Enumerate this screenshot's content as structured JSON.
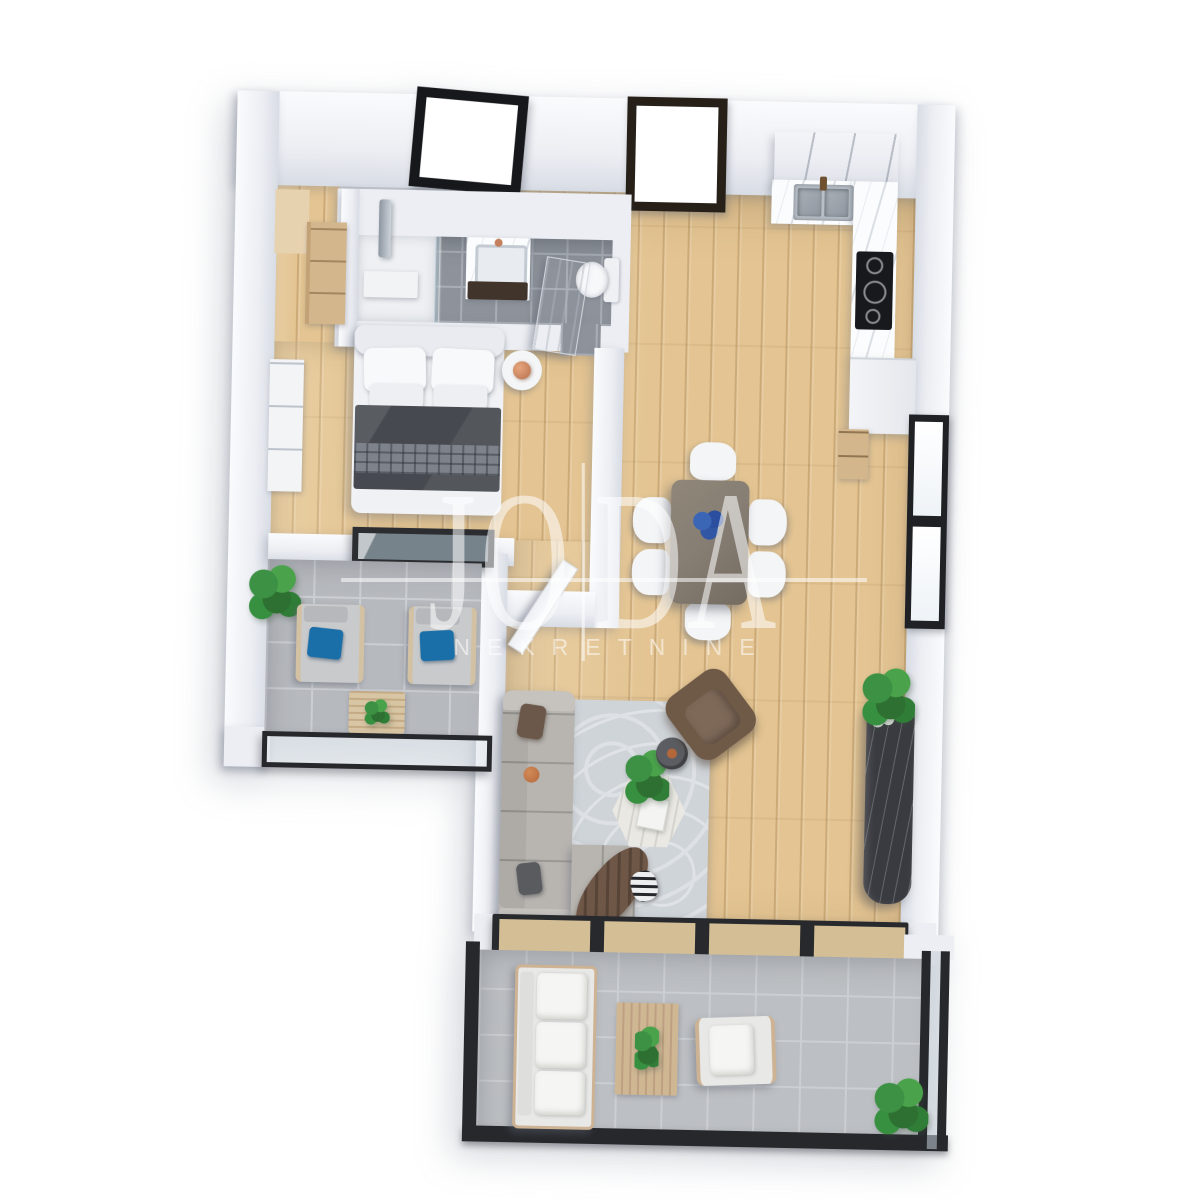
{
  "watermark": {
    "brand_left": "JO",
    "brand_right": "DA",
    "subtitle": "NEKRETNINE"
  },
  "palette": {
    "background": "#ffffff",
    "wall_top": "#fafbfd",
    "wall_face": "#eceef3",
    "wall_shade": "#d8dce4",
    "wood": "#e3c492",
    "wood_light": "#ecd4a6",
    "wood_furniture": "#d3b68c",
    "bath_tile": "#8e939b",
    "bath_grout": "#a9aeb6",
    "out_tile": "#b6b9be",
    "out_grout": "#cbced2",
    "shower_white": "#eef0f3",
    "rug": "#cfd4d9",
    "rug_pattern": "#dde1e5",
    "sofa": "#b8b5b1",
    "sofa_light": "#c6c3bf",
    "cushion_brown": "#6b584a",
    "cushion_grey": "#595b5f",
    "throw_brown": "#6f5747",
    "armchair": "#6f5947",
    "table_dark": "#877e74",
    "chair_white": "#f4f5f7",
    "bed_white": "#f1f2f5",
    "blanket": "#46494f",
    "blanket_band": "#7d828b",
    "accent_blue": "#1b6fa8",
    "flower_blue": "#3156a4",
    "plant": "#3c9144",
    "plant_dark": "#2e7031",
    "frame_dark": "#26282c",
    "door_frame": "#262019",
    "glass": "rgba(170,188,200,0.6)",
    "copper": "#c4805c",
    "marble": "#fbfcfd",
    "console": "#3a3b41",
    "steel": "#b9bfc6",
    "orange_deco": "#b3683c",
    "watermark": "rgba(255,255,255,0.55)"
  }
}
